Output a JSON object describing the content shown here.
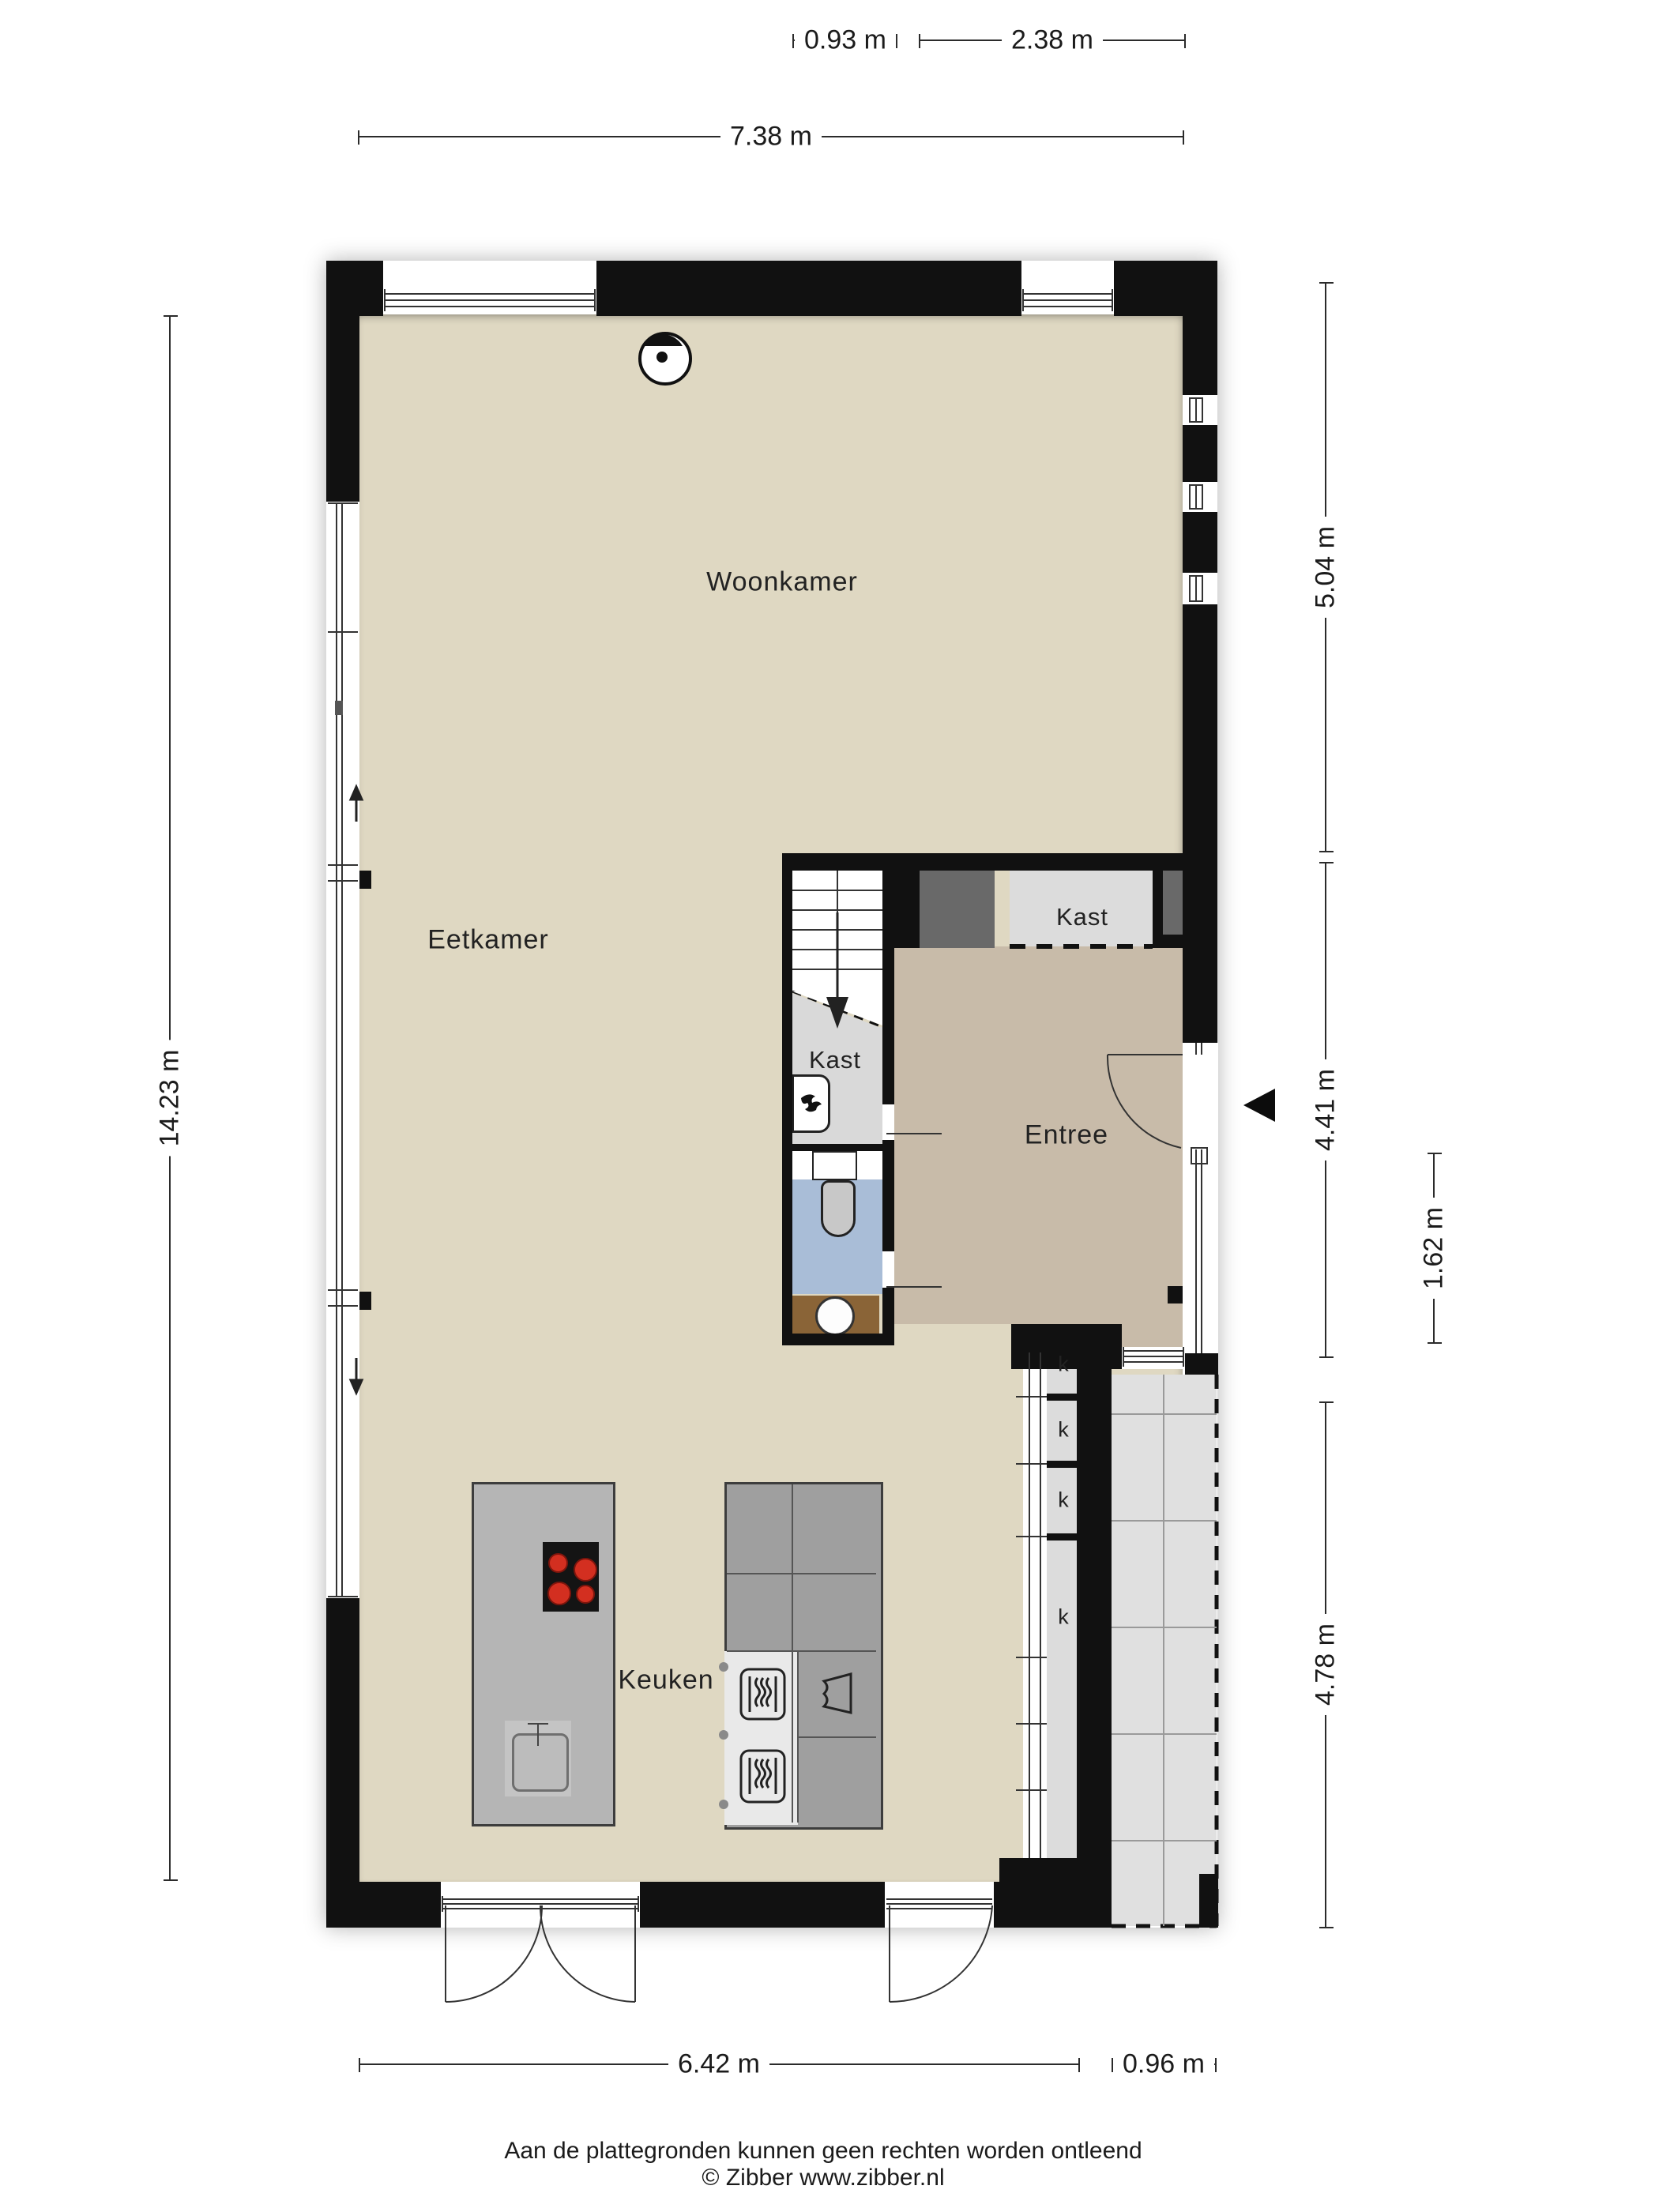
{
  "rooms": {
    "woonkamer": "Woonkamer",
    "eetkamer": "Eetkamer",
    "keuken": "Keuken",
    "entree": "Entree",
    "kast_under_stairs": "Kast",
    "kast_hall": "Kast",
    "k_label": "k"
  },
  "dimensions": {
    "top_stair_width": "0.93 m",
    "top_entree_width": "2.38 m",
    "top_total_width": "7.38 m",
    "left_total_height": "14.23 m",
    "right_upper": "5.04 m",
    "right_middle": "4.41 m",
    "right_inner": "1.62 m",
    "right_lower": "4.78 m",
    "bottom_width": "6.42 m",
    "bottom_right_width": "0.96 m"
  },
  "footer": {
    "disclaimer": "Aan de plattegronden kunnen geen rechten worden ontleend",
    "copyright": "© Zibber www.zibber.nl"
  },
  "colors": {
    "wall": "#111111",
    "floor_main": "#dfd8c2",
    "floor_entree": "#c8bba9",
    "floor_closet": "#dcdcdc",
    "floor_toilet": "#a9bdd7",
    "counter_wood": "#8a6437",
    "dark_shaft": "#696969",
    "kitchen_island": "#b5b5b5",
    "kitchen_counter": "#9f9f9f",
    "terrace": "#e0e0e0",
    "burner_red": "#d32f20"
  },
  "icons": [
    "ceiling-light-icon",
    "boiler-flame-icon",
    "toilet-icon",
    "sink-icon",
    "cooktop-icon",
    "oven-icon",
    "cabinet-door-icon",
    "entrance-arrow-icon",
    "stairs-down-arrow-icon",
    "sliding-door-arrow-icon"
  ]
}
